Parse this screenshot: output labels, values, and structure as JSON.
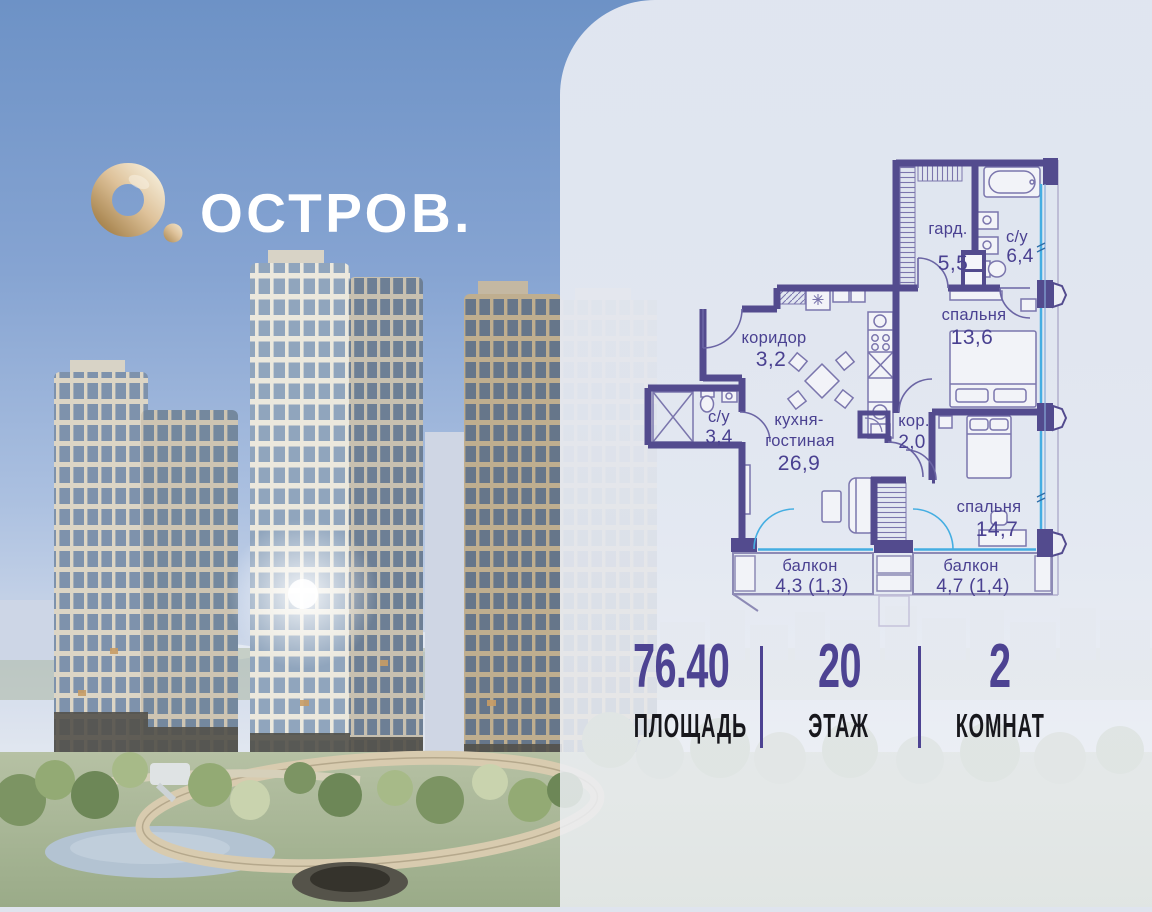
{
  "brand": {
    "name": "ОСТРОВ.",
    "logo_icon": "gold-ring-o-icon"
  },
  "plan": {
    "wardrobe": {
      "name": "гард.",
      "area": "5,5"
    },
    "bathroom_large": {
      "name": "с/у",
      "area": "6,4"
    },
    "bedroom_large": {
      "name": "спальня",
      "area": "13,6"
    },
    "hallway": {
      "name": "коридор",
      "area": "3,2"
    },
    "kitchen_living": {
      "line1": "кухня-",
      "line2": "гостиная",
      "area": "26,9"
    },
    "bathroom_small": {
      "name": "с/у",
      "area": "3,4"
    },
    "corridor": {
      "name": "кор.",
      "area": "2,0"
    },
    "bedroom_small": {
      "name": "спальня",
      "area": "14,7"
    },
    "balcony_left": {
      "name": "балкон",
      "area": "4,3 (1,3)"
    },
    "balcony_right": {
      "name": "балкон",
      "area": "4,7 (1,4)"
    }
  },
  "stats": {
    "area": {
      "value": "76.40",
      "label": "ПЛОЩАДЬ"
    },
    "floor": {
      "value": "20",
      "label": "ЭТАЖ"
    },
    "rooms": {
      "value": "2",
      "label": "КОМНАТ"
    }
  },
  "colors": {
    "accent": "#4d4392",
    "plan_wall": "#534b8e",
    "plan_text": "#4a4191",
    "window_glass": "#45aee2",
    "logo_gold": "#d6ba8c"
  }
}
